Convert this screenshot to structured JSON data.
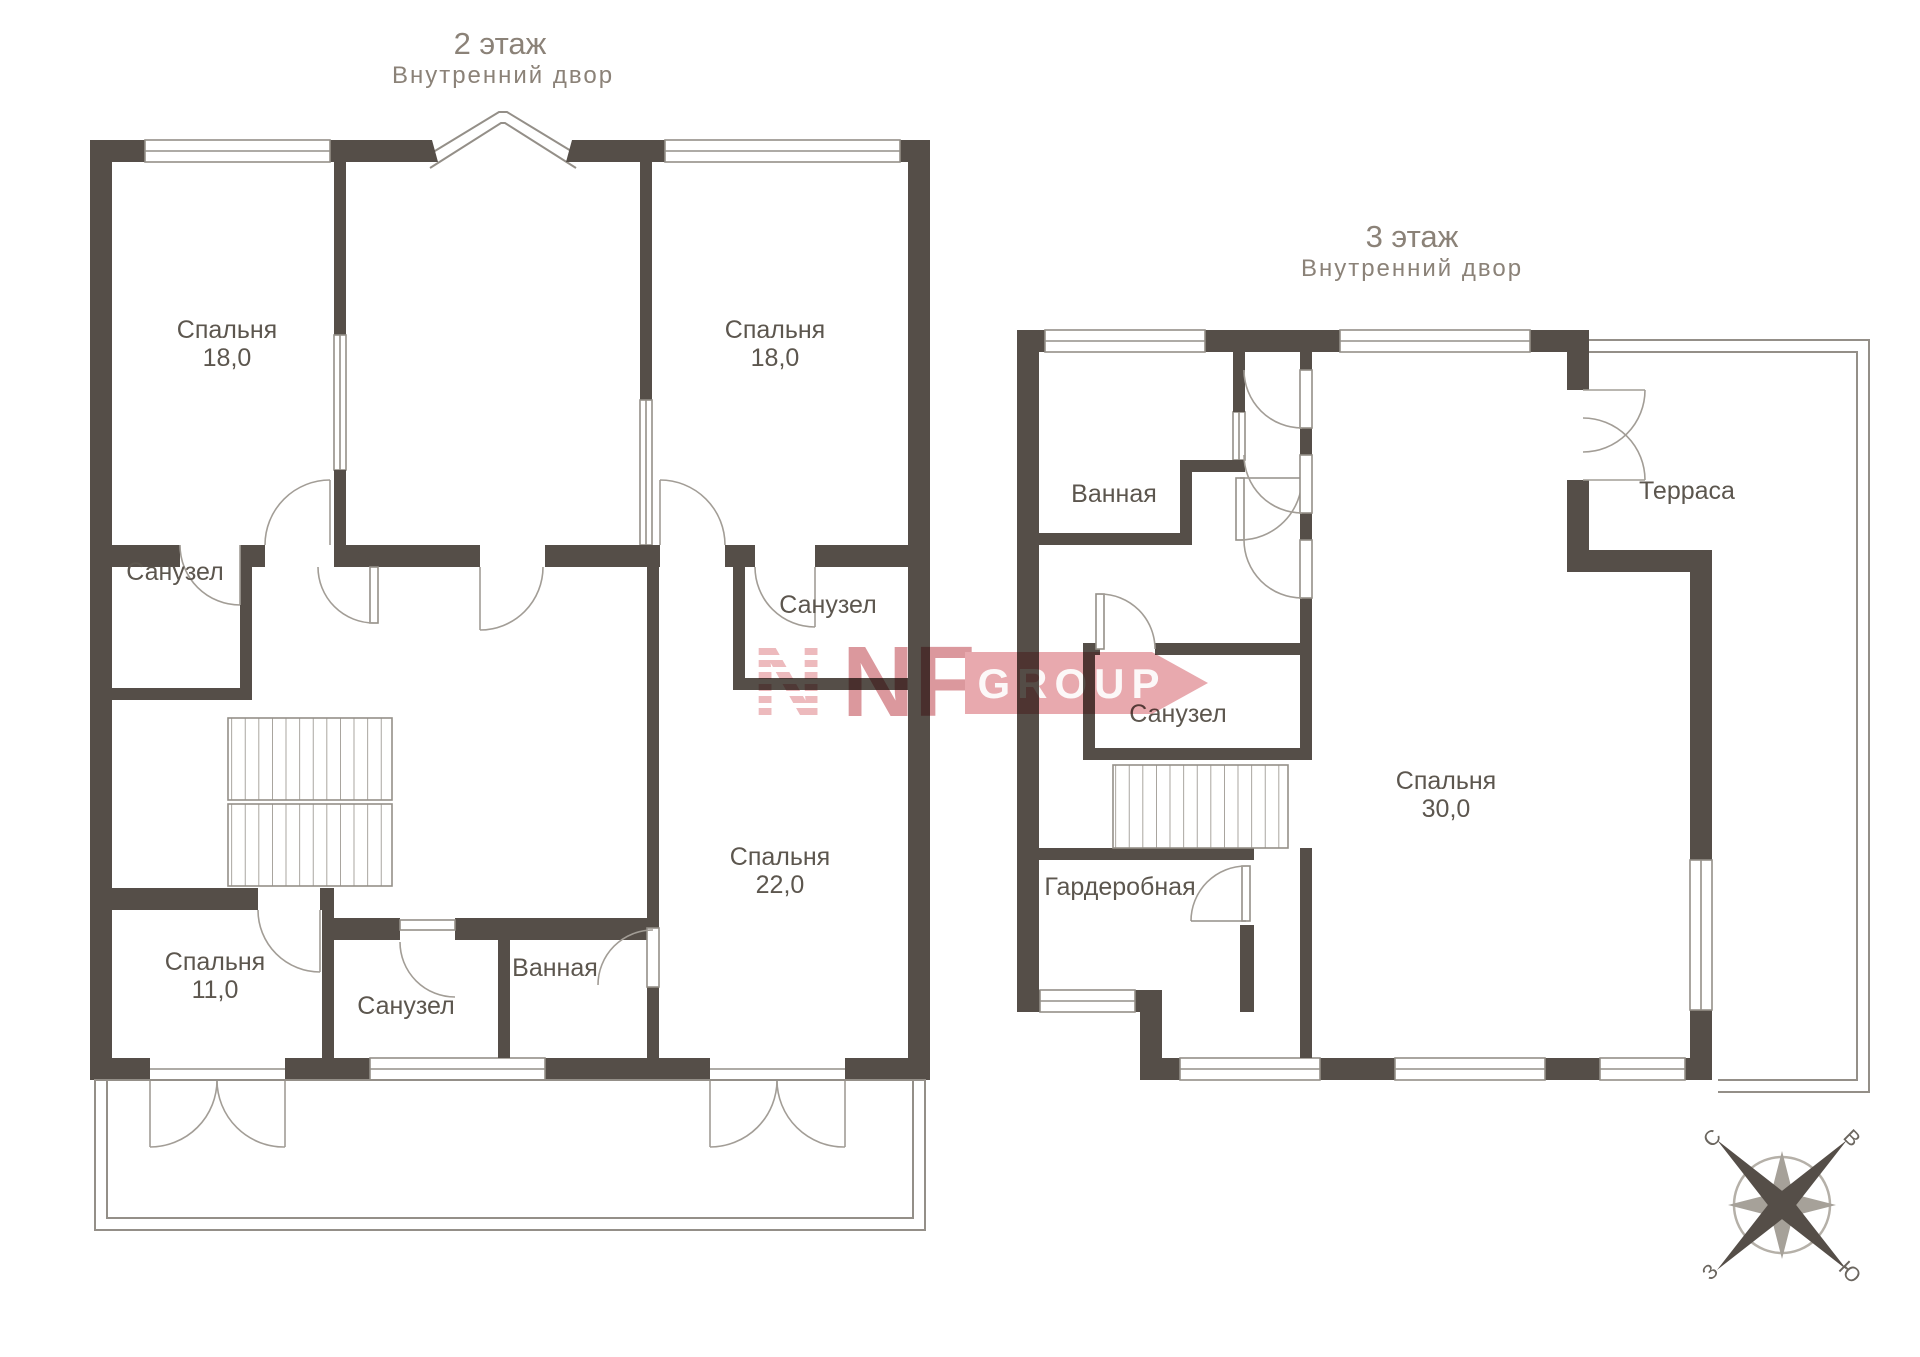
{
  "colors": {
    "wall": "#554e48",
    "thin_line": "#948f88",
    "room_label_text": "#5c564e",
    "title_text": "#8b8278",
    "watermark_solid": "#d5868c",
    "watermark_stripe": "#eaaeb2",
    "watermark_banner": "#e49aa0",
    "compass_dark": "#554e48",
    "compass_light": "#a6a199"
  },
  "floor2": {
    "title": "2 этаж",
    "subtitle": "Внутренний двор",
    "rooms": {
      "bedroom_tl": {
        "name": "Спальня",
        "area": "18,0"
      },
      "bedroom_tr": {
        "name": "Спальня",
        "area": "18,0"
      },
      "bath_left": {
        "name": "Санузел"
      },
      "bath_right": {
        "name": "Санузел"
      },
      "bedroom_big": {
        "name": "Спальня",
        "area": "22,0"
      },
      "bedroom_bl": {
        "name": "Спальня",
        "area": "11,0"
      },
      "bath_bottom": {
        "name": "Санузел"
      },
      "bathroom": {
        "name": "Ванная"
      }
    }
  },
  "floor3": {
    "title": "3 этаж",
    "subtitle": "Внутренний двор",
    "rooms": {
      "bathroom": {
        "name": "Ванная"
      },
      "terrace": {
        "name": "Терраса"
      },
      "bath": {
        "name": "Санузел"
      },
      "bedroom": {
        "name": "Спальня",
        "area": "30,0"
      },
      "wardrobe": {
        "name": "Гардеробная"
      }
    }
  },
  "watermark": {
    "emblem": "N",
    "brand": "NF",
    "suffix": "GROUP"
  },
  "compass": {
    "north": "С",
    "east": "В",
    "south": "Ю",
    "west": "З"
  }
}
